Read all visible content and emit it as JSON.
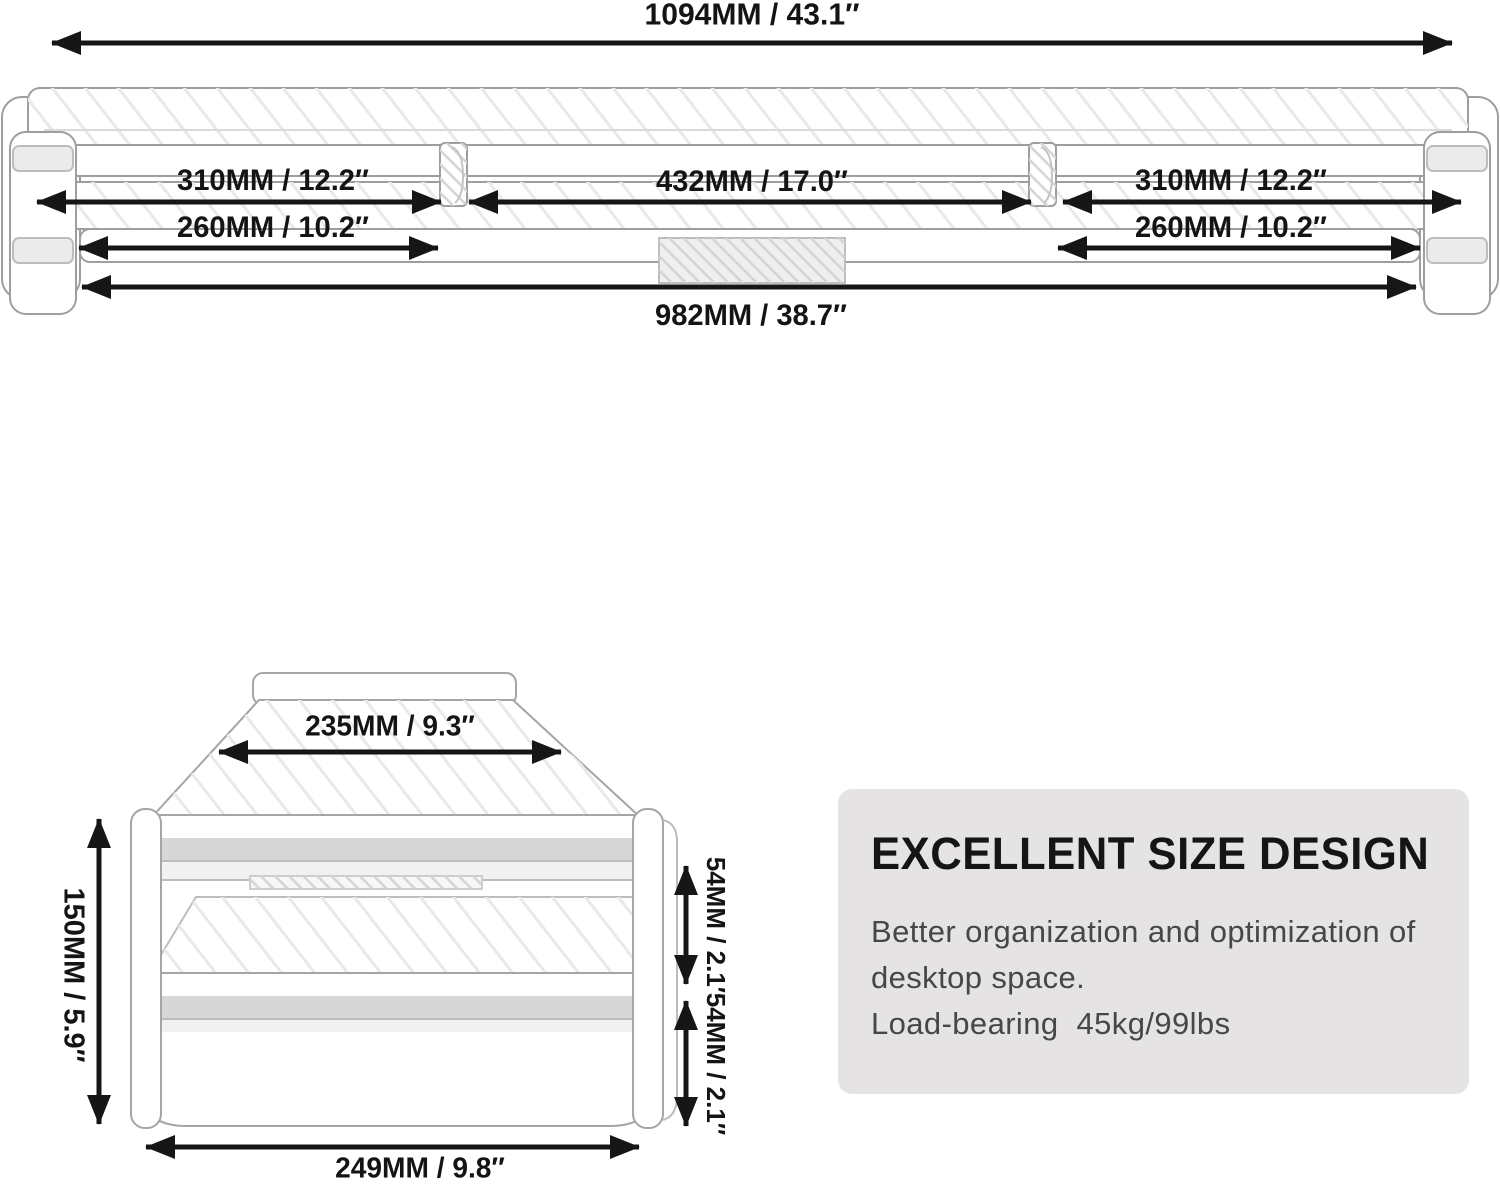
{
  "colors": {
    "dimension_ink": "#161616",
    "line_art": "#9e9e9e",
    "card_bg": "#e5e3e4",
    "shelf_edge_gray": "#d7d7d7"
  },
  "top_view": {
    "width_total": "1094MM / 43.1″",
    "left_segment": "310MM / 12.2″",
    "center_segment": "432MM / 17.0″",
    "right_segment": "310MM / 12.2″",
    "left_lower_segment": "260MM / 10.2″",
    "right_lower_segment": "260MM / 10.2″",
    "base_width": "982MM / 38.7″"
  },
  "side_view": {
    "top_depth": "235MM / 9.3″",
    "total_height": "150MM / 5.9″",
    "upper_clearance": "54MM / 2.1″",
    "lower_clearance": "54MM / 2.1″",
    "base_depth": "249MM / 9.8″"
  },
  "info_card": {
    "title": "EXCELLENT SIZE DESIGN",
    "line1": "Better organization and optimization of",
    "line2": "desktop space.",
    "line3": "Load-bearing  45kg/99lbs"
  }
}
